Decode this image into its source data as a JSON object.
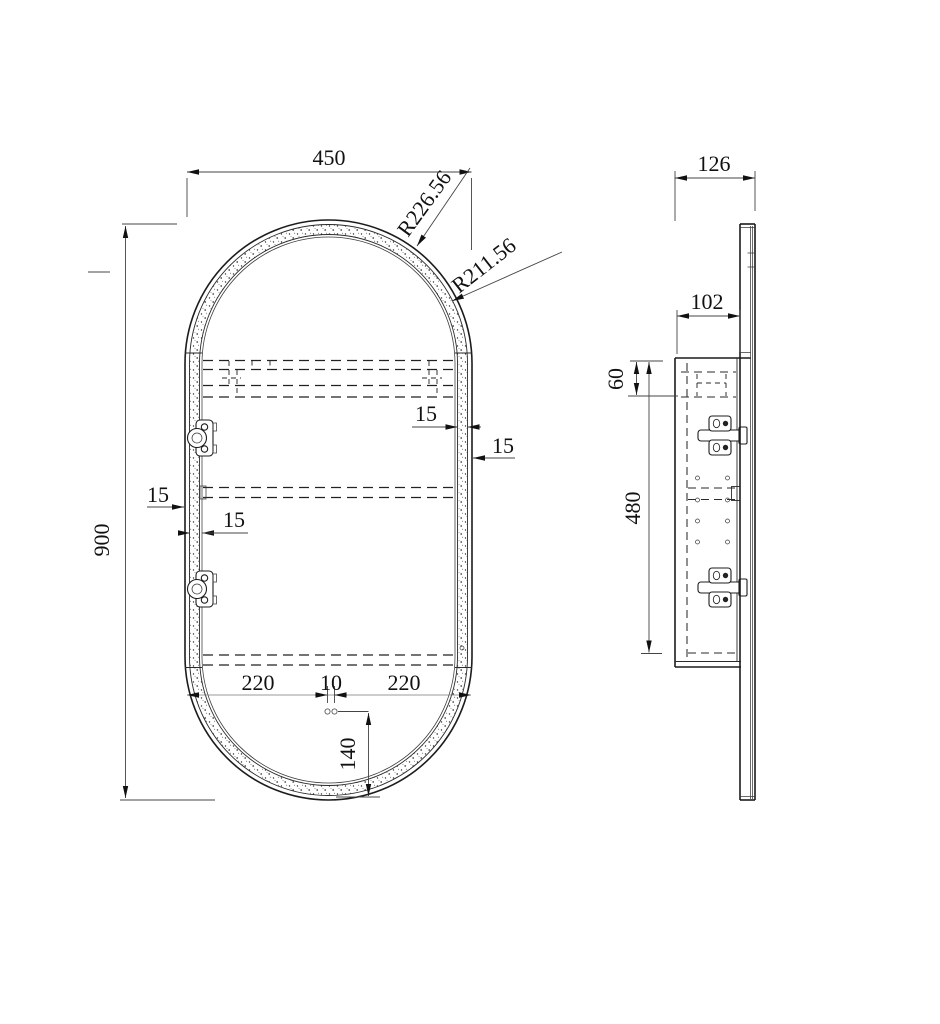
{
  "front_view": {
    "width": "450",
    "height": "900",
    "radius_outer": "R226.56",
    "radius_inner": "R211.56",
    "led_strip_right": "15",
    "frame_right": "15",
    "frame_left": "15",
    "led_strip_left": "15",
    "bottom_left": "220",
    "bottom_gap": "10",
    "bottom_right": "220",
    "hole_offset": "140"
  },
  "side_view": {
    "depth_total": "126",
    "cabinet_depth": "102",
    "top_inset": "60",
    "cabinet_height": "480"
  }
}
